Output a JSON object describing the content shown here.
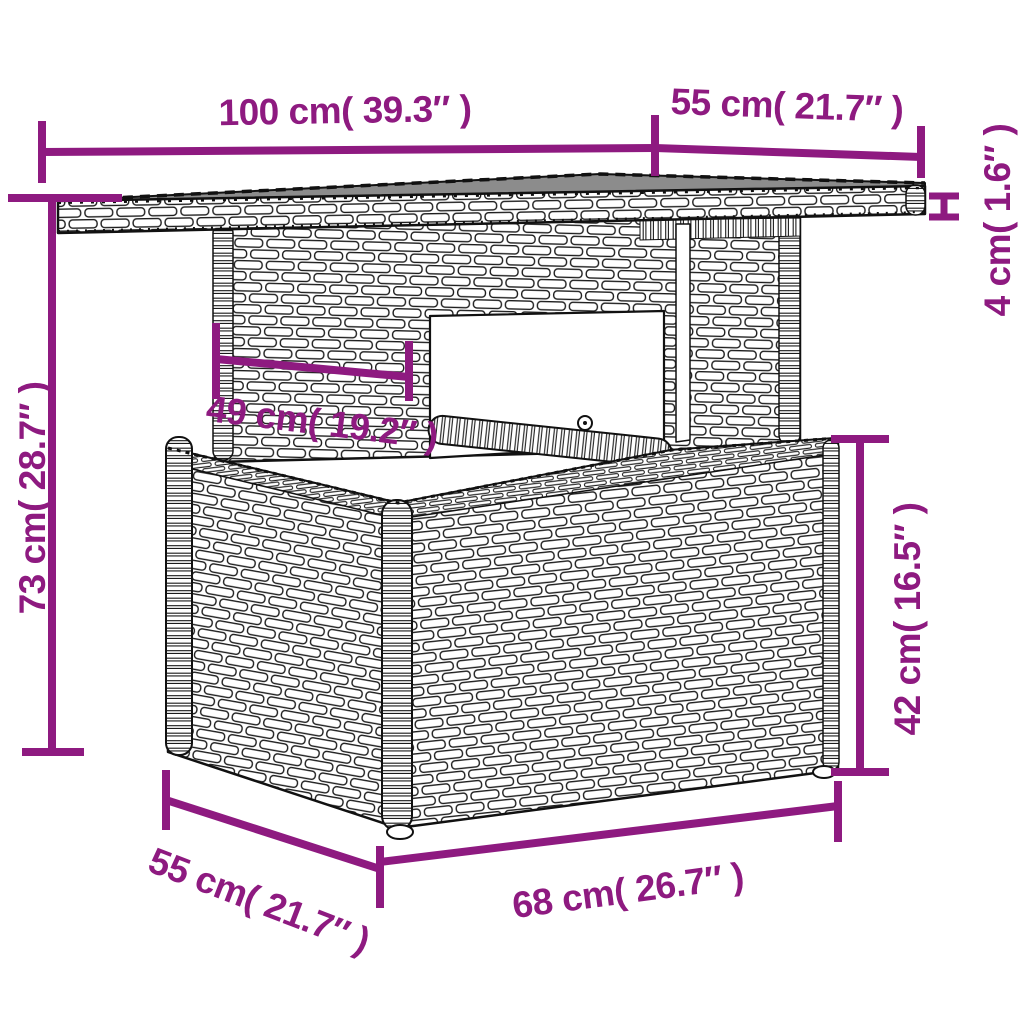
{
  "diagram": {
    "kind": "product-dimension-diagram",
    "product": "poly rattan garden table",
    "colors": {
      "accent": "#8E1A80",
      "line_art": "#1a1a1a",
      "glass_top": "#8C8C8C",
      "background": "#FFFFFF"
    },
    "units": {
      "primary": "cm",
      "secondary": "inches"
    },
    "dimensions": {
      "tabletop_length": {
        "cm": 100,
        "in": 39.3,
        "label": "100 cm( 39.3″ )"
      },
      "tabletop_depth": {
        "cm": 55,
        "in": 21.7,
        "label": "55 cm( 21.7″ )"
      },
      "tabletop_thickness": {
        "cm": 4,
        "in": 1.6,
        "label": "4 cm( 1.6″ )"
      },
      "total_height": {
        "cm": 73,
        "in": 28.7,
        "label": "73 cm( 28.7″ )"
      },
      "pedestal_width": {
        "cm": 49,
        "in": 19.2,
        "label": "49 cm( 19.2″ )"
      },
      "base_height": {
        "cm": 42,
        "in": 16.5,
        "label": "42 cm( 16.5″ )"
      },
      "base_depth": {
        "cm": 55,
        "in": 21.7,
        "label": "55 cm( 21.7″ )"
      },
      "base_width": {
        "cm": 68,
        "in": 26.7,
        "label": "68 cm( 26.7″ )"
      }
    }
  }
}
